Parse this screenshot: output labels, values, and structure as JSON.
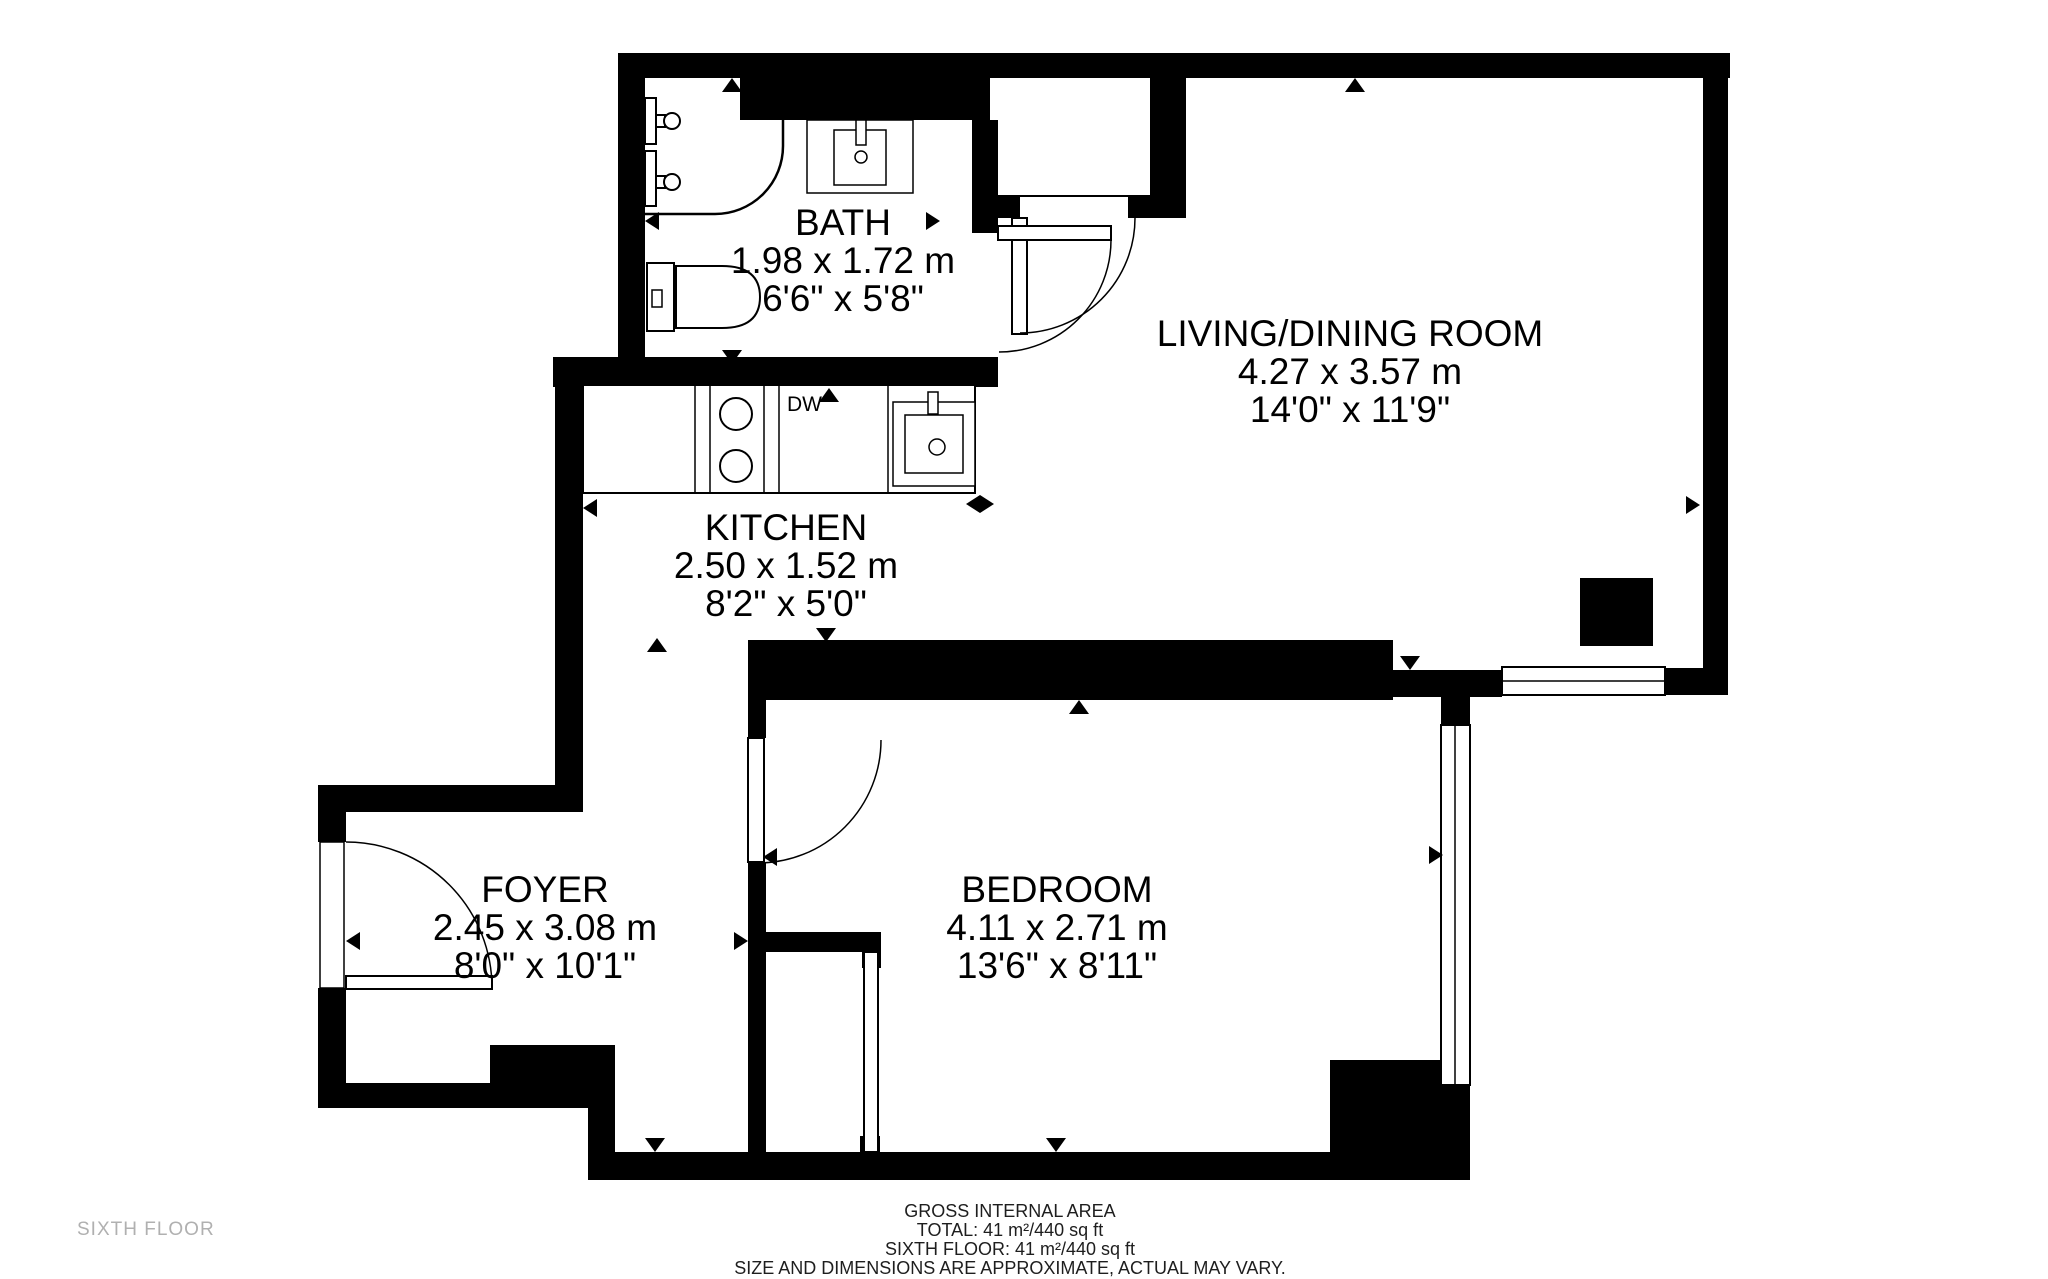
{
  "floor_label": "SIXTH FLOOR",
  "rooms": {
    "bath": {
      "name": "BATH",
      "metric": "1.98 x 1.72 m",
      "imperial": "6'6\" x 5'8\""
    },
    "kitchen": {
      "name": "KITCHEN",
      "metric": "2.50 x 1.52 m",
      "imperial": "8'2\" x 5'0\""
    },
    "living": {
      "name": "LIVING/DINING ROOM",
      "metric": "4.27 x 3.57 m",
      "imperial": "14'0\" x 11'9\""
    },
    "foyer": {
      "name": "FOYER",
      "metric": "2.45 x 3.08 m",
      "imperial": "8'0\" x 10'1\""
    },
    "bedroom": {
      "name": "BEDROOM",
      "metric": "4.11 x 2.71 m",
      "imperial": "13'6\" x 8'11\""
    }
  },
  "appliances": {
    "dishwasher": "DW"
  },
  "footer": {
    "title": "GROSS INTERNAL AREA",
    "total": "TOTAL: 41 m²/440 sq ft",
    "floor_total": "SIXTH FLOOR: 41 m²/440 sq ft",
    "disclaimer": "SIZE AND DIMENSIONS ARE APPROXIMATE, ACTUAL MAY VARY."
  },
  "colors": {
    "wall": "#000000",
    "floor": "#ffffff",
    "muted_text": "#b0b0b0"
  }
}
